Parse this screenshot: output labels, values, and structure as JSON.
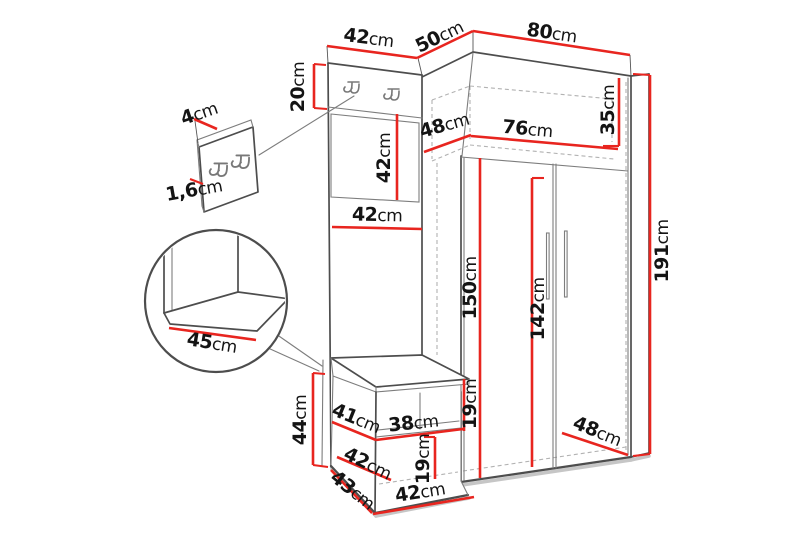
{
  "diagram": {
    "kind": "corner hallway furniture dimension drawing",
    "unit": "cm",
    "accent_color": "#e8251f",
    "line_color": "#4d4d4d"
  },
  "dims": {
    "top42": {
      "v": "42",
      "u": "cm"
    },
    "top50": {
      "v": "50",
      "u": "cm"
    },
    "top80": {
      "v": "80",
      "u": "cm"
    },
    "band20": {
      "v": "20",
      "u": "cm"
    },
    "inset4": {
      "v": "4",
      "u": "cm"
    },
    "inset16": {
      "v": "1,6",
      "u": "cm"
    },
    "hookpanel42": {
      "v": "42",
      "u": "cm"
    },
    "inner48top": {
      "v": "48",
      "u": "cm"
    },
    "inner76": {
      "v": "76",
      "u": "cm"
    },
    "inner35": {
      "v": "35",
      "u": "cm"
    },
    "panel42mid": {
      "v": "42",
      "u": "cm"
    },
    "door150": {
      "v": "150",
      "u": "cm"
    },
    "door142": {
      "v": "142",
      "u": "cm"
    },
    "height191": {
      "v": "191",
      "u": "cm"
    },
    "seat45": {
      "v": "45",
      "u": "cm"
    },
    "bench44": {
      "v": "44",
      "u": "cm"
    },
    "bench41": {
      "v": "41",
      "u": "cm"
    },
    "bench38": {
      "v": "38",
      "u": "cm"
    },
    "bench19a": {
      "v": "19",
      "u": "cm"
    },
    "bench42left": {
      "v": "42",
      "u": "cm"
    },
    "bench19b": {
      "v": "19",
      "u": "cm"
    },
    "bench43": {
      "v": "43",
      "u": "cm"
    },
    "bench42bot": {
      "v": "42",
      "u": "cm"
    },
    "depth48bot": {
      "v": "48",
      "u": "cm"
    }
  }
}
